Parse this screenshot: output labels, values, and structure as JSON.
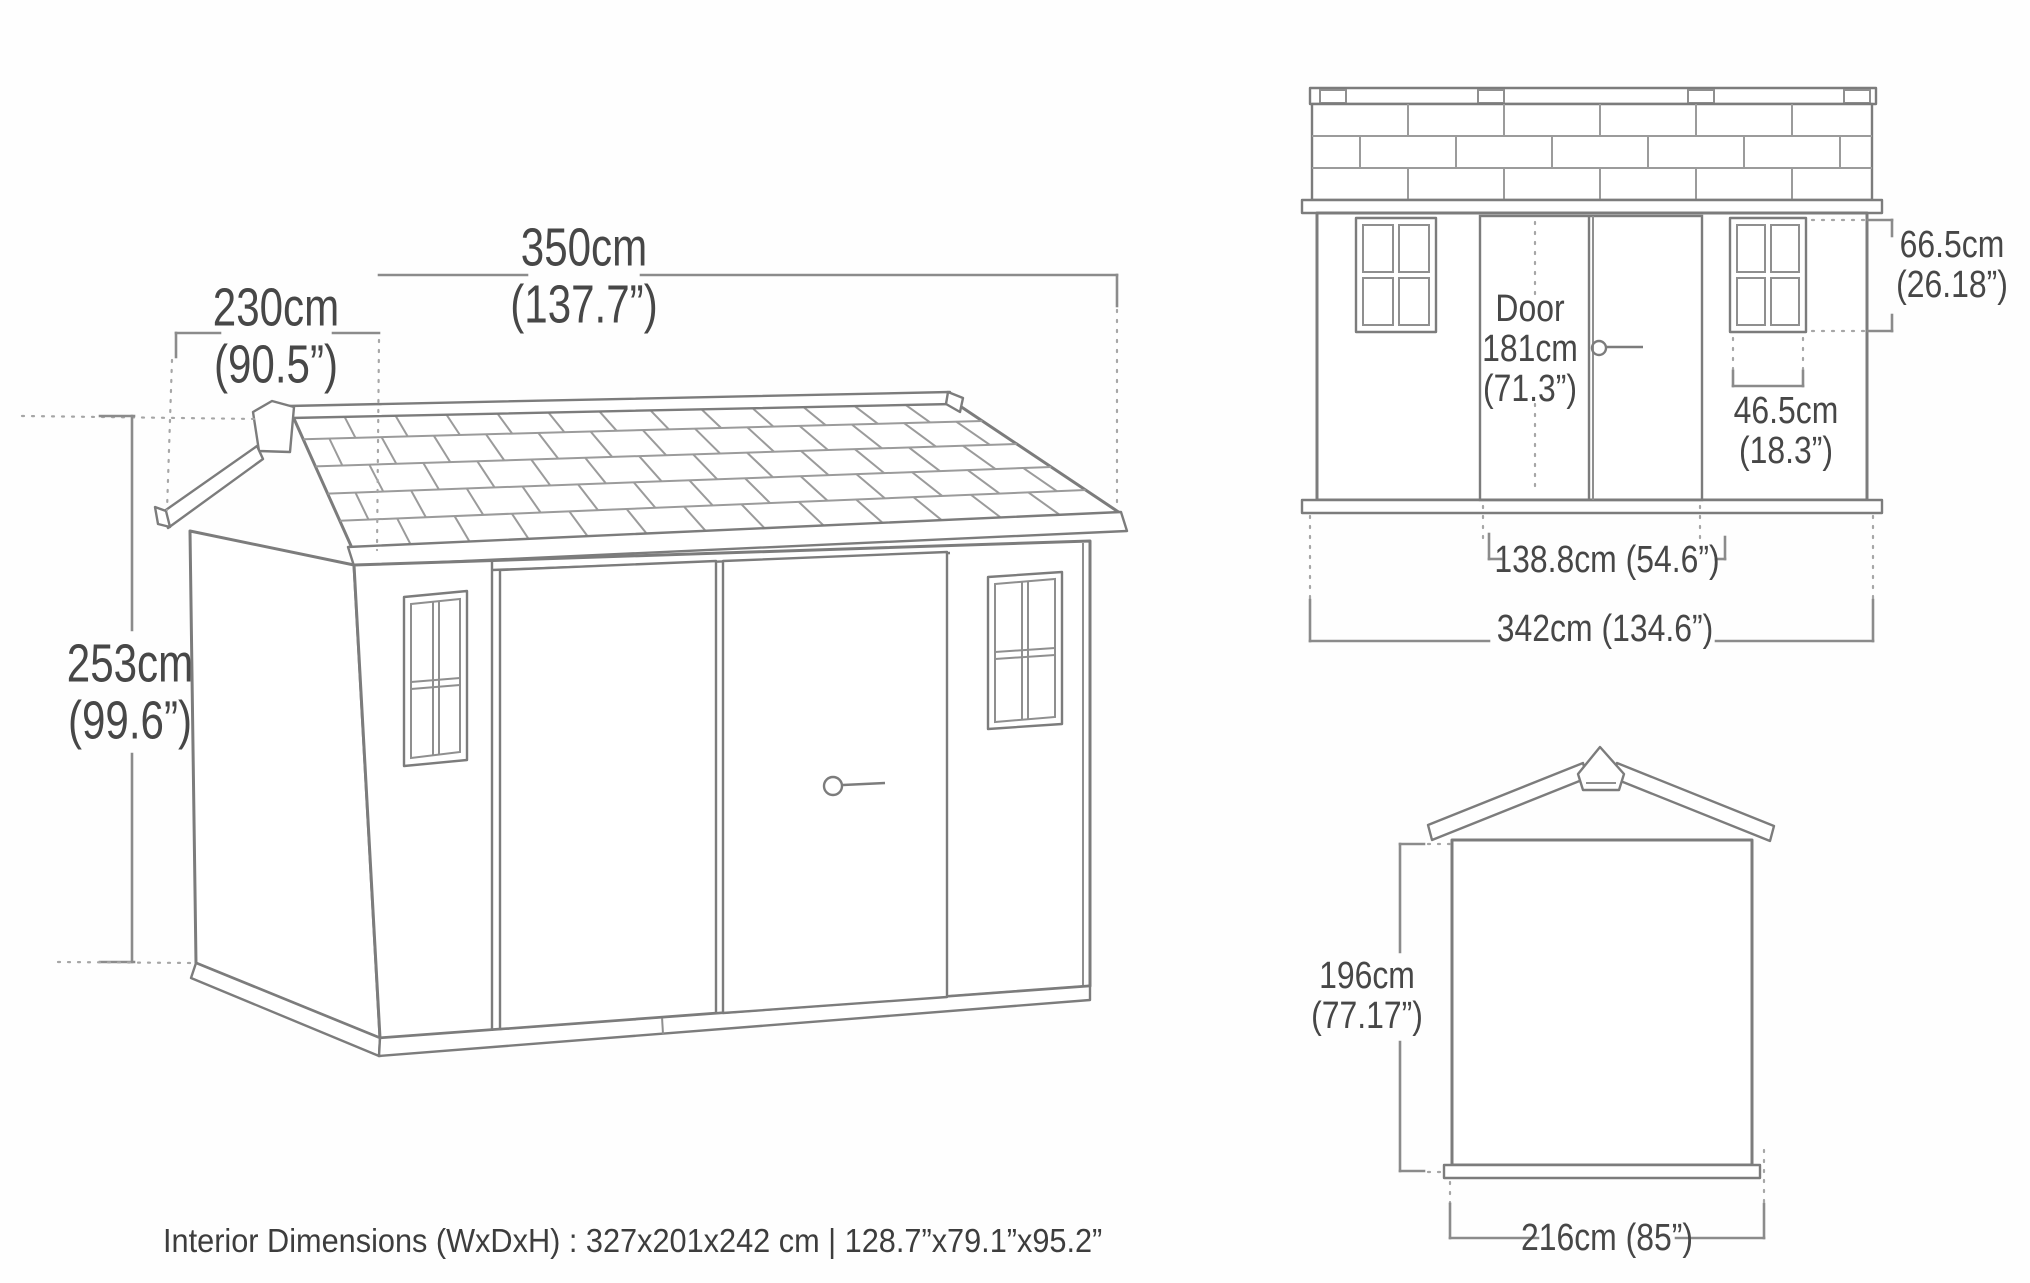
{
  "page": {
    "background": "#fefefe",
    "line_color": "#7c7c7c",
    "text_color": "#474747"
  },
  "caption": "Interior Dimensions (WxDxH) : 327x201x242 cm | 128.7”x79.1”x95.2”",
  "isometric_view": {
    "depth": {
      "cm": "230cm",
      "in": "(90.5”)"
    },
    "width": {
      "cm": "350cm",
      "in": "(137.7”)"
    },
    "height": {
      "cm": "253cm",
      "in": "(99.6”)"
    }
  },
  "front_view": {
    "door": {
      "label": "Door",
      "cm": "181cm",
      "in": "(71.3”)"
    },
    "window_height": {
      "cm": "66.5cm",
      "in": "(26.18”)"
    },
    "window_width": {
      "cm": "46.5cm",
      "in": "(18.3”)"
    },
    "door_width": "138.8cm (54.6”)",
    "overall_width": "342cm (134.6”)"
  },
  "rear_view": {
    "wall_height": {
      "cm": "196cm",
      "in": "(77.17”)"
    },
    "overall_width": "216cm (85”)"
  }
}
